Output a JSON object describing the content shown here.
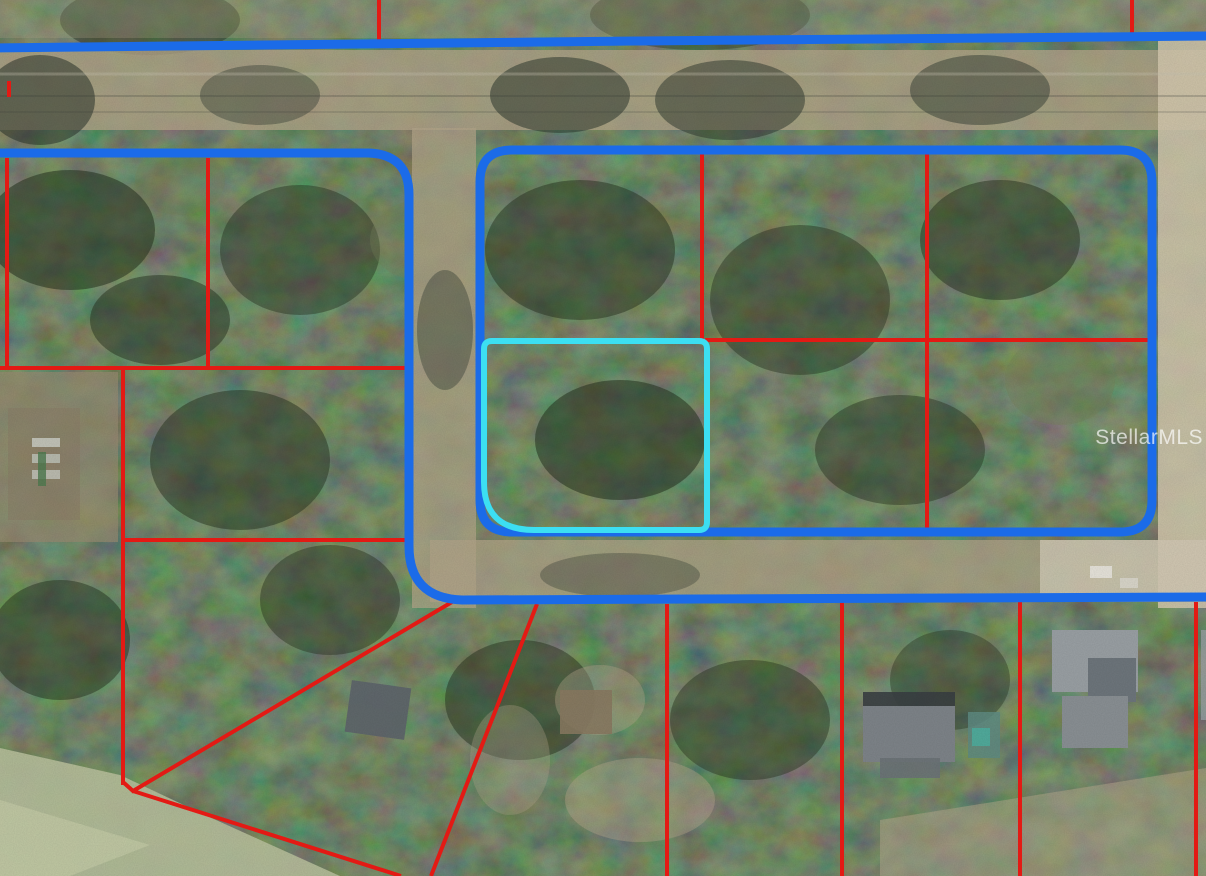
{
  "map": {
    "watermark": "StellarMLS",
    "colors": {
      "road_outline_blue": "#1b6be8",
      "parcel_line_red": "#e31a14",
      "subject_parcel_cyan": "#3cdff2",
      "forest_base": "#49543e",
      "road_surface_tan": "#b3a58a",
      "road_surface_bright": "#d5c9af",
      "grass_field_green": "#b8c09c",
      "clearing_tan": "#998b72",
      "roof_gray": "#9aa0a4",
      "roof_dark_gray": "#5f666b",
      "pool_teal": "#5f8c82",
      "shed_brown": "#8a7a62",
      "watermark_white": "#ffffff"
    }
  }
}
